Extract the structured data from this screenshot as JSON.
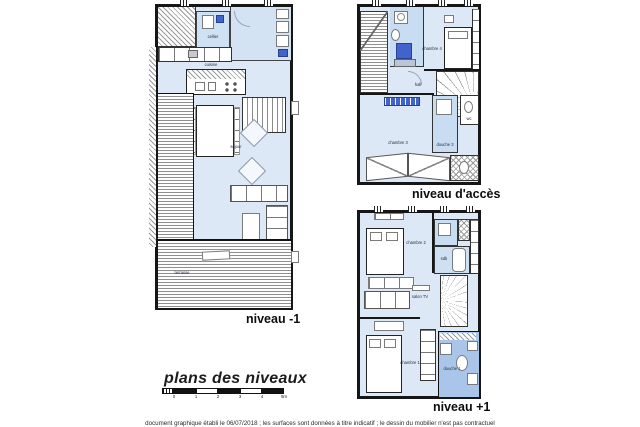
{
  "title": {
    "text": "plans des niveaux"
  },
  "scalebar": {
    "tick_labels": [
      "0",
      "1",
      "2",
      "3",
      "4",
      "5m"
    ]
  },
  "caption": {
    "text": "document graphique établi le 06/07/2018 ; les surfaces sont données à titre indicatif ; le dessin du mobilier n'est pas contractuel"
  },
  "plans": [
    {
      "label": "niveau -1",
      "rooms": [
        {
          "label": "cellier"
        },
        {
          "label": "cuisine"
        },
        {
          "label": "séjour"
        },
        {
          "label": "terrasse"
        }
      ]
    },
    {
      "label": "niveau d'accès",
      "rooms": [
        {
          "label": "chambre 4"
        },
        {
          "label": "hall"
        },
        {
          "label": "chambre 3"
        },
        {
          "label": "douche 3"
        },
        {
          "label": "wc"
        }
      ]
    },
    {
      "label": "niveau +1",
      "rooms": [
        {
          "label": "chambre 2"
        },
        {
          "label": "sdb"
        },
        {
          "label": "salon TV"
        },
        {
          "label": "chambre 1"
        },
        {
          "label": "douche 1"
        }
      ]
    }
  ],
  "colors": {
    "wall": "#161616",
    "floor_blue": "#dce8f5",
    "bath_blue": "#c9ddf2",
    "accent_blue": "#4064cc",
    "hatch_gray": "#8f8f8f",
    "background": "#ffffff"
  }
}
